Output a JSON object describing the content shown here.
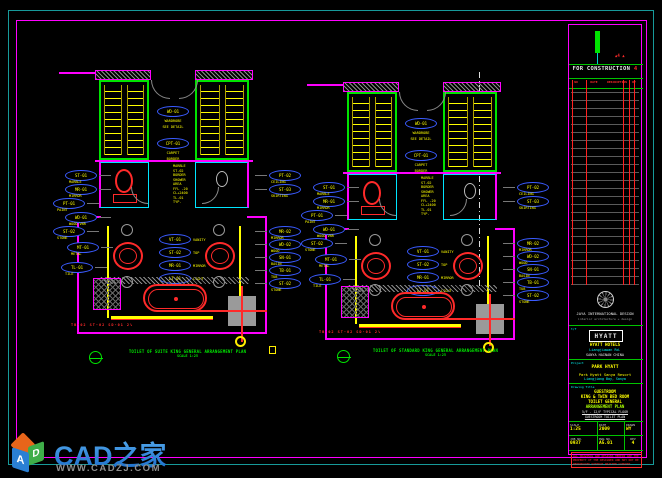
{
  "colors": {
    "magenta": "#ff00ff",
    "yellow": "#ffff00",
    "green": "#00e400",
    "cyan": "#00e5ff",
    "red": "#ff2a2a",
    "tag_blue": "#3a5bff",
    "gray": "#808080",
    "teal_border": "#179a9a"
  },
  "watermark": {
    "brand": "CAD之家",
    "url": "WWW.CADZJ.COM",
    "cube_letters": {
      "left": "A",
      "right": "D"
    }
  },
  "plans": {
    "a": {
      "title": "TOILET OF SUITE KING GENERAL ARRANGEMENT PLAN",
      "scale": "SCALE 1:25",
      "room_tags": [
        {
          "code": "WD-01",
          "cap1": "WARDROBE",
          "cap2": "SEE DETAIL",
          "y": 40
        },
        {
          "code": "CPT-01",
          "cap1": "CARPET",
          "cap2": "BORDER",
          "y": 72
        }
      ],
      "left_tags": [
        {
          "code": "ST-01",
          "cap": "MARBLE",
          "x": 10,
          "y": 104
        },
        {
          "code": "MR-01",
          "cap": "MIRROR",
          "x": 10,
          "y": 118
        },
        {
          "code": "PT-01",
          "cap": "PAINT",
          "x": -2,
          "y": 132
        },
        {
          "code": "WD-01",
          "cap": "WOOD VNR",
          "x": 10,
          "y": 146
        },
        {
          "code": "ST-02",
          "cap": "STONE",
          "x": -2,
          "y": 160
        },
        {
          "code": "MT-01",
          "cap": "METAL",
          "x": 12,
          "y": 176
        },
        {
          "code": "TL-01",
          "cap": "TILE",
          "x": 6,
          "y": 196
        }
      ],
      "right_tags": [
        {
          "code": "PT-02",
          "cap": "CEILING",
          "x": 200,
          "y": 104
        },
        {
          "code": "ST-03",
          "cap": "SKIRTING",
          "x": 200,
          "y": 118
        },
        {
          "code": "MR-02",
          "cap": "MIRROR",
          "x": 200,
          "y": 160
        },
        {
          "code": "WD-02",
          "cap": "WOOD",
          "x": 200,
          "y": 173
        },
        {
          "code": "SN-01",
          "cap": "BASIN",
          "x": 200,
          "y": 186
        },
        {
          "code": "TB-01",
          "cap": "TUB",
          "x": 200,
          "y": 199
        },
        {
          "code": "ST-02",
          "cap": "STONE",
          "x": 200,
          "y": 212
        }
      ],
      "center_tags": [
        {
          "code": "VT-01",
          "cap": "VANITY",
          "y": 168
        },
        {
          "code": "ST-02",
          "cap": "TOP",
          "y": 181
        },
        {
          "code": "MR-01",
          "cap": "MIRROR",
          "y": 194
        },
        {
          "code": "LT-01",
          "cap": "LIGHT",
          "y": 207
        }
      ],
      "notes": [
        {
          "t": "MARBLE"
        },
        {
          "t": "ST-02"
        },
        {
          "t": "BORDER"
        },
        {
          "t": "SHOWER"
        },
        {
          "t": "AREA"
        },
        {
          "t": "FFL -20"
        },
        {
          "t": "CL+2400"
        },
        {
          "t": "TL-01"
        },
        {
          "t": "TYP."
        }
      ],
      "bottom_note": "TB-02  ST-02  SD-01  2%"
    },
    "b": {
      "title": "TOILET OF STANDARD KING GENERAL ARRANGEMENT PLAN",
      "scale": "SCALE 1:25",
      "room_tags": [
        {
          "code": "WD-01",
          "cap1": "WARDROBE",
          "cap2": "SEE DETAIL",
          "y": 40
        },
        {
          "code": "CPT-01",
          "cap1": "CARPET",
          "cap2": "BORDER",
          "y": 72
        }
      ],
      "left_tags": [
        {
          "code": "ST-01",
          "cap": "MARBLE",
          "x": 10,
          "y": 104
        },
        {
          "code": "MR-01",
          "cap": "MIRROR",
          "x": 10,
          "y": 118
        },
        {
          "code": "PT-01",
          "cap": "PAINT",
          "x": -2,
          "y": 132
        },
        {
          "code": "WD-01",
          "cap": "WOOD VNR",
          "x": 10,
          "y": 146
        },
        {
          "code": "ST-02",
          "cap": "STONE",
          "x": -2,
          "y": 160
        },
        {
          "code": "MT-01",
          "cap": "METAL",
          "x": 12,
          "y": 176
        },
        {
          "code": "TL-01",
          "cap": "TILE",
          "x": 6,
          "y": 196
        }
      ],
      "right_tags": [
        {
          "code": "PT-02",
          "cap": "CEILING",
          "x": 200,
          "y": 104
        },
        {
          "code": "ST-03",
          "cap": "SKIRTING",
          "x": 200,
          "y": 118
        },
        {
          "code": "MR-02",
          "cap": "MIRROR",
          "x": 200,
          "y": 160
        },
        {
          "code": "WD-02",
          "cap": "WOOD",
          "x": 200,
          "y": 173
        },
        {
          "code": "SN-01",
          "cap": "BASIN",
          "x": 200,
          "y": 186
        },
        {
          "code": "TB-01",
          "cap": "TUB",
          "x": 200,
          "y": 199
        },
        {
          "code": "ST-02",
          "cap": "STONE",
          "x": 200,
          "y": 212
        }
      ],
      "center_tags": [
        {
          "code": "VT-01",
          "cap": "VANITY",
          "y": 168
        },
        {
          "code": "ST-02",
          "cap": "TOP",
          "y": 181
        },
        {
          "code": "MR-01",
          "cap": "MIRROR",
          "y": 194
        },
        {
          "code": "LT-01",
          "cap": "LIGHT",
          "y": 207
        }
      ],
      "notes": [
        {
          "t": "MARBLE"
        },
        {
          "t": "ST-02"
        },
        {
          "t": "BORDER"
        },
        {
          "t": "SHOWER"
        },
        {
          "t": "AREA"
        },
        {
          "t": "FFL -20"
        },
        {
          "t": "CL+2400"
        },
        {
          "t": "TL-01"
        },
        {
          "t": "TYP."
        }
      ],
      "bottom_note": "TB-02  ST-02  SD-01  2%"
    }
  },
  "title_block": {
    "status": "FOR CONSTRUCTION",
    "status_rev": "4",
    "rev_cols": {
      "no": "NO",
      "date": "DATE",
      "desc": "DESCRIPTION",
      "by": "BY"
    },
    "firm": {
      "name": "JAYA INTERNATIONAL DESIGN",
      "sub": "interior architecture + design"
    },
    "client": {
      "tel": "t/f",
      "brand": "HYATT",
      "line1": "HYATT HOTELS",
      "line2": "Liangjiawan Rd.",
      "line3": "SANYA HAINAN CHINA"
    },
    "project": {
      "label": "Project",
      "name": "PARK HYATT",
      "line2": "Park Hyatt Sanya Resort",
      "line3": "Liangjiang Bay, Sanya"
    },
    "drawing": {
      "label": "Drawing Title",
      "line1": "GUESTROOM",
      "line2": "KING & TWIN BED ROOM",
      "line3": "TOILET GENERAL",
      "line4": "ARRANGEMENT PLAN",
      "line5": "5/F - 12/F TYPICAL FLOOR",
      "line6": "GUESTROOM TOILET PLAN"
    },
    "info": {
      "scale_label": "SCALE",
      "scale": "1:25",
      "date_label": "DATE",
      "date": "2009",
      "drawn_label": "DRAWN",
      "drawn": "WY",
      "job_label": "JOB NO.",
      "job": "0937",
      "dwg_label": "DWG NO.",
      "dwg": "A5.01",
      "rev_label": "REV",
      "rev": "4"
    },
    "notice": {
      "l1": "ALL DRAWINGS AND DESIGNS HEREIN ARE THE",
      "l2": "PROPERTY OF THE DESIGNER AND MAY NOT BE",
      "l3": "REPRODUCED WITHOUT WRITTEN CONSENT."
    }
  }
}
